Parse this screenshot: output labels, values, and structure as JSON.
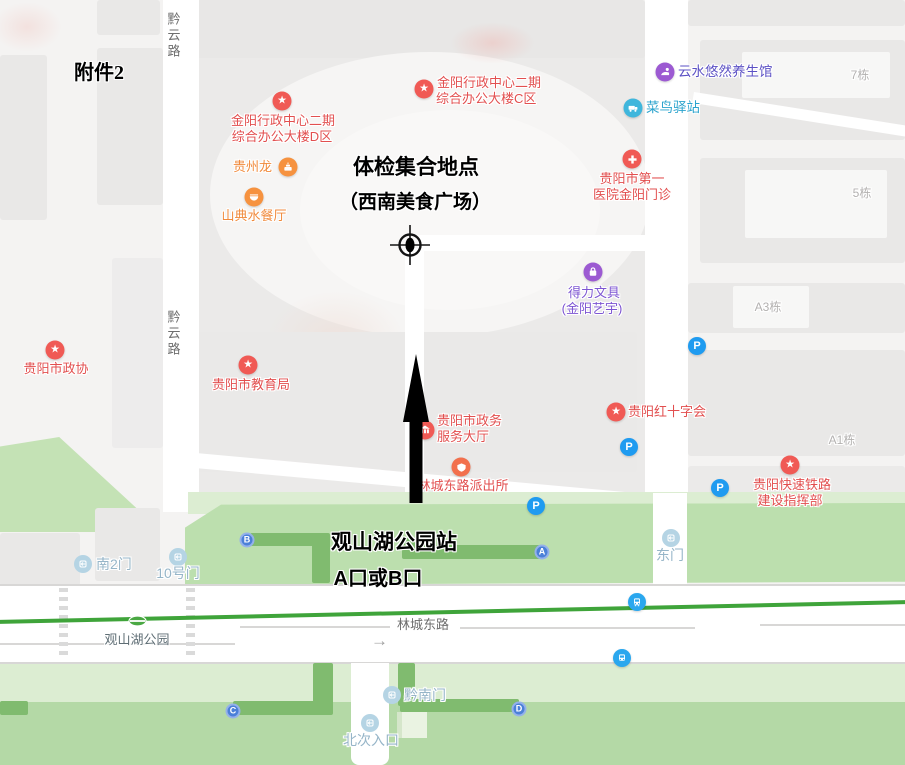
{
  "annotations": {
    "attachment": "附件2",
    "meeting1": "体检集合地点",
    "meeting2": "（西南美食广场）",
    "station1": "观山湖公园站",
    "station2": "A口或B口"
  },
  "roads": {
    "qianyun": "黔云路",
    "lincheng": "林城东路"
  },
  "metro": {
    "station": "观山湖公园",
    "entrance_a": "A",
    "entrance_b": "B",
    "entrance_c": "C",
    "entrance_d": "D"
  },
  "icons": {
    "parking": "P",
    "one_way": "→",
    "star": "★"
  },
  "pois": {
    "jinyang_d": {
      "line1": "金阳行政中心二期",
      "line2": "综合办公大楼D区"
    },
    "jinyang_c": {
      "line1": "金阳行政中心二期",
      "line2": "综合办公大楼C区"
    },
    "guizhoulong": {
      "label": "贵州龙"
    },
    "shandian": {
      "label": "山典水餐厅"
    },
    "yunshui": {
      "label": "云水悠然养生馆"
    },
    "cainiao": {
      "label": "菜鸟驿站"
    },
    "hospital": {
      "line1": "贵阳市第一",
      "line2": "医院金阳门诊"
    },
    "deli": {
      "line1": "得力文具",
      "line2": "(金阳艺宇)"
    },
    "zhengxie": {
      "label": "贵阳市政协"
    },
    "jiaoyuju": {
      "label": "贵阳市教育局"
    },
    "zhengwu": {
      "line1": "贵阳市政务",
      "line2": "服务大厅"
    },
    "paichusuo": {
      "label": "林城东路派出所"
    },
    "hongshizi": {
      "label": "贵阳红十字会"
    },
    "tielu": {
      "line1": "贵阳快速铁路",
      "line2": "建设指挥部"
    }
  },
  "buildings": {
    "b7": "7栋",
    "b5": "5栋",
    "a3": "A3栋",
    "a1": "A1栋"
  },
  "gates": {
    "dongmen": "东门",
    "nan2men": "南2门",
    "gate10": "10号门",
    "qiannan": "黔南门",
    "beici": "北次入口"
  },
  "colors": {
    "poi_red": "#f05a55",
    "poi_orange": "#f6923f",
    "poi_purple": "#9c5ad2",
    "poi_teal": "#3fb6dc",
    "parking_blue": "#1f9bf0",
    "entrance_blue": "#4b80d8",
    "metro_line_green": "#3fa43a",
    "park_green": "#bcdfae",
    "park_path_green": "#80bb6f",
    "label_red": "#e24f4f",
    "gate_label_blue": "#96b5c8",
    "annotation_black": "#000000"
  }
}
